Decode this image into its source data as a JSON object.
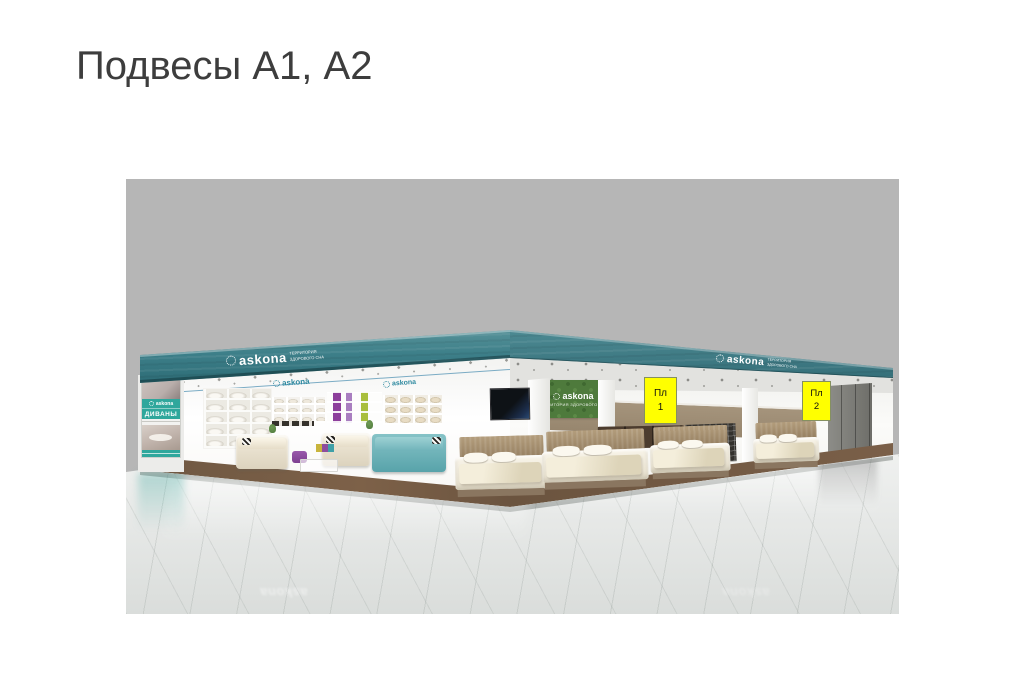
{
  "slide": {
    "title": "Подвесы А1, А2"
  },
  "brand": {
    "name": "askona",
    "tagline_line1": "ТЕРРИТОРИЯ",
    "tagline_line2": "ЗДОРОВОГО СНА",
    "tagline_full": "ТЕРРИТОРИЯ ЗДОРОВОГО СНА"
  },
  "render": {
    "background_color": "#b6b6b6",
    "fascia_color": "#3d7f89",
    "banner_teal_color": "#2fa79c",
    "label_color": "#ffff00",
    "banner": {
      "brand": "askona",
      "category_label": "ДИВАНЫ"
    },
    "interior_signs": {
      "left_sign_1": "askona",
      "left_sign_2": "askona",
      "green_sign": "askona"
    },
    "labels": [
      {
        "line1": "Пл",
        "line2": "1"
      },
      {
        "line1": "Пл",
        "line2": "2"
      }
    ],
    "reflection_text": "askona"
  }
}
